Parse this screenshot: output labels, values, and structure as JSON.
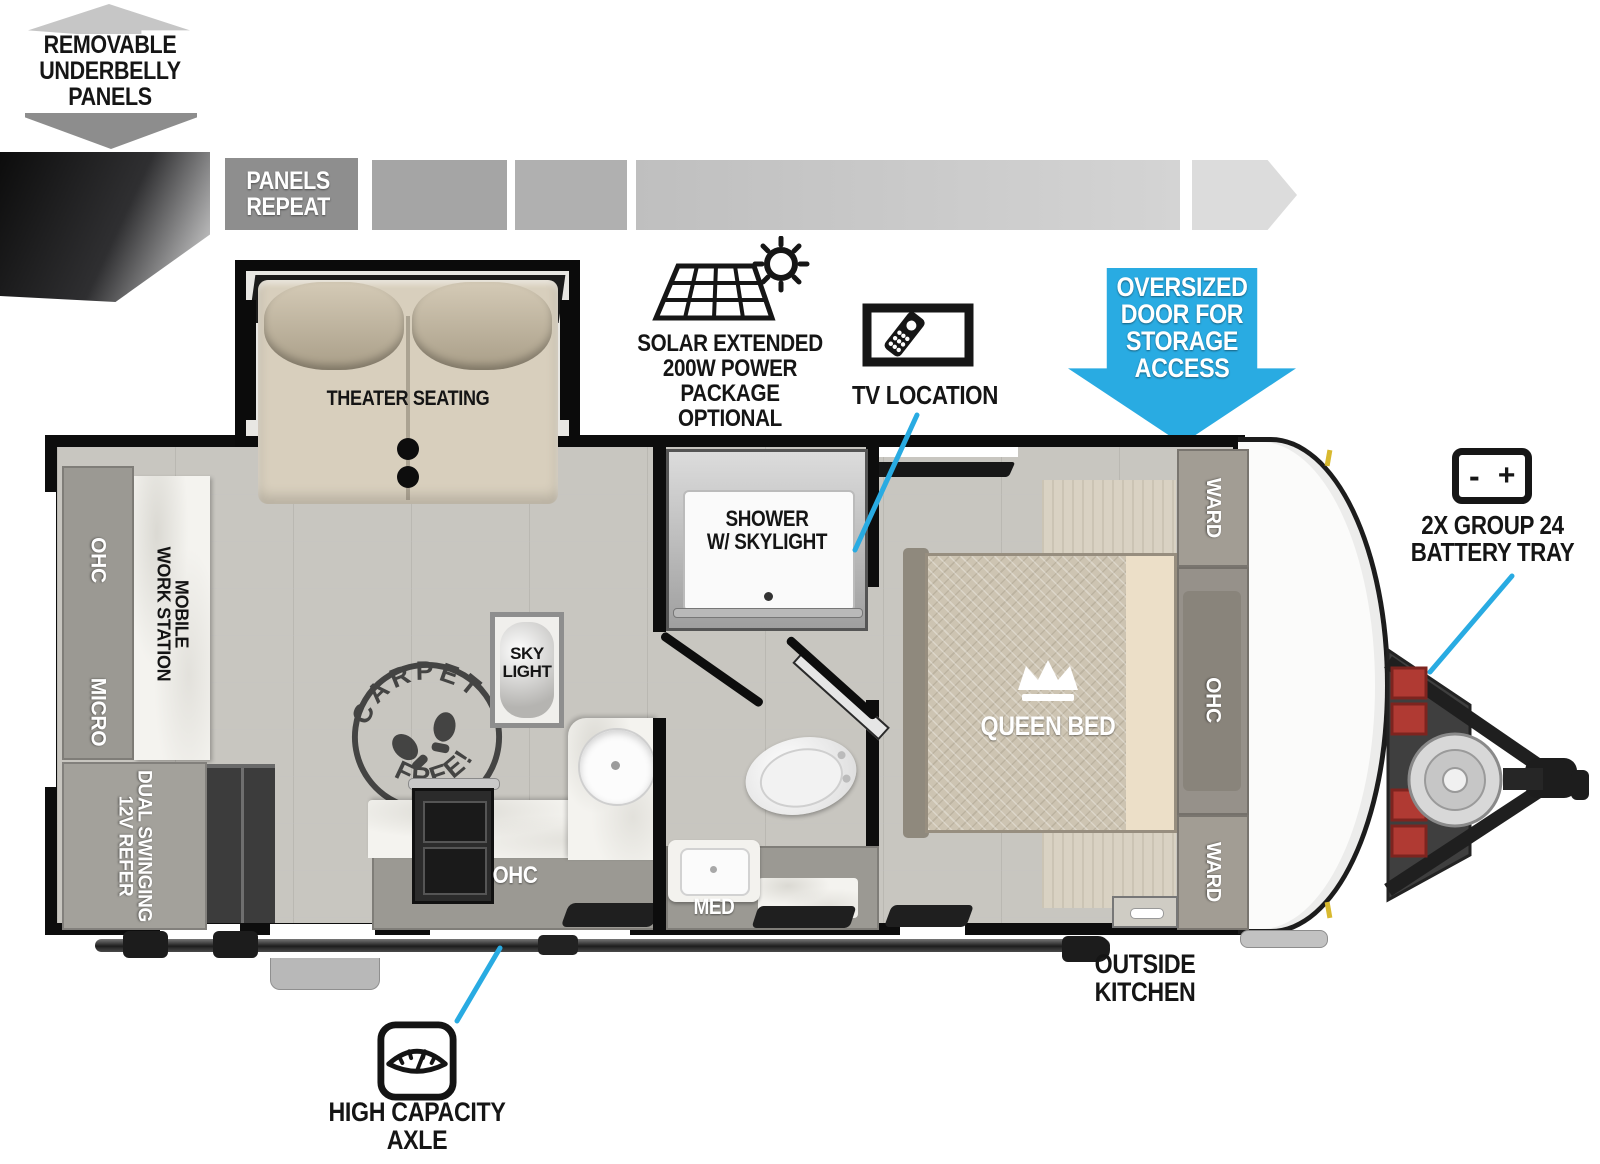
{
  "palette": {
    "accent_blue": "#29ABE2",
    "wall_black": "#0d0d0d",
    "floor_gray": "#c8c6c0",
    "cabinet_gray": "#9b9993",
    "counter_white": "#f4f3ef",
    "bed_tan": "#cdc4b2",
    "seat_tan": "#d8cfbd",
    "battery_red": "#b03a33"
  },
  "callouts": {
    "underbelly": {
      "label": "REMOVABLE\nUNDERBELLY\nPANELS"
    },
    "panels_repeat": {
      "label": "PANELS\nREPEAT"
    },
    "solar": {
      "label": "SOLAR EXTENDED\n200W POWER PACKAGE\nOPTIONAL"
    },
    "tv": {
      "label": "TV LOCATION"
    },
    "oversized_door": {
      "label": "OVERSIZED\nDOOR FOR\nSTORAGE\nACCESS"
    },
    "battery": {
      "label": "2X GROUP 24\nBATTERY TRAY",
      "minus": "-",
      "plus": "+"
    },
    "outside_kitchen": {
      "label": "OUTSIDE\nKITCHEN"
    },
    "axle": {
      "label": "HIGH CAPACITY\nAXLE"
    }
  },
  "rooms": {
    "theater_seating": "THEATER SEATING",
    "shower": "SHOWER\nW/ SKYLIGHT",
    "sky_light": "SKY\nLIGHT",
    "queen_bed": "QUEEN BED",
    "ward_front_top": "WARD",
    "ward_front_bottom": "WARD",
    "ohc_bedroom": "OHC",
    "ohc_rear": "OHC",
    "micro": "MICRO",
    "refer": "DUAL SWINGING\n12V REFER",
    "workstation": "MOBILE\nWORK STATION",
    "ohc_kitchen": "OHC",
    "med": "MED",
    "carpet_free": {
      "top": "CARPET",
      "bottom": "FREE!"
    }
  }
}
